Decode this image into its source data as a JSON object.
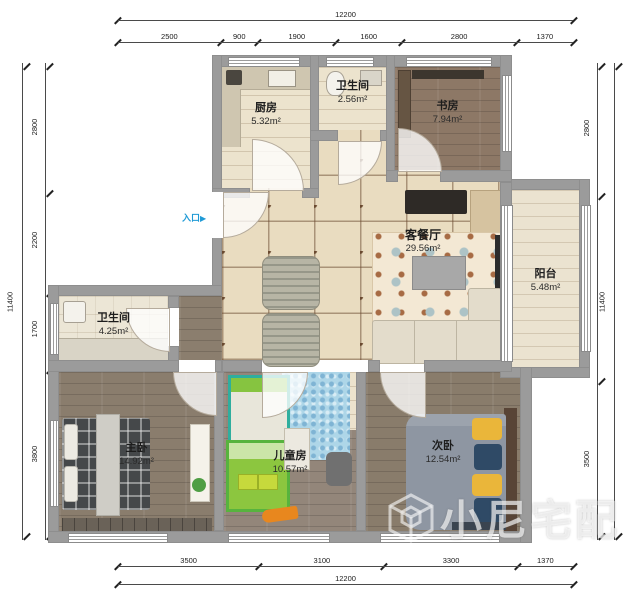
{
  "colors": {
    "accent_blue": "#1f9ad6",
    "wall_gray": "#9b9b9b",
    "tile_beige": "#e9dcc0",
    "wood_brown": "#8a7d6d",
    "grid_brown": "#6a4a30"
  },
  "entry": {
    "label": "入口",
    "arrow": "▶"
  },
  "watermark": {
    "text": "小尼宅配"
  },
  "rooms": {
    "kitchen": {
      "name": "厨房",
      "area": "5.32m²"
    },
    "bath_top": {
      "name": "卫生间",
      "area": "2.56m²"
    },
    "study": {
      "name": "书房",
      "area": "7.94m²"
    },
    "living": {
      "name": "客餐厅",
      "area": "29.56m²"
    },
    "balcony": {
      "name": "阳台",
      "area": "5.48m²"
    },
    "bath_left": {
      "name": "卫生间",
      "area": "4.25m²"
    },
    "master": {
      "name": "主卧",
      "area": "14.92m²"
    },
    "kids": {
      "name": "儿童房",
      "area": "10.57m²"
    },
    "second": {
      "name": "次卧",
      "area": "12.54m²"
    }
  },
  "dimensions": {
    "top_total": [
      "12200"
    ],
    "top_segments": [
      "2500",
      "900",
      "1900",
      "1600",
      "2800",
      "1370"
    ],
    "bottom_segments": [
      "3500",
      "3100",
      "3300",
      "1370"
    ],
    "bottom_total": [
      "12200"
    ],
    "left_total": [
      "11400"
    ],
    "left_segments": [
      "2800",
      "2200",
      "1700",
      "3800"
    ],
    "right_segments": [
      "2800",
      "4000",
      "3500"
    ],
    "right_total": [
      "11400"
    ]
  }
}
